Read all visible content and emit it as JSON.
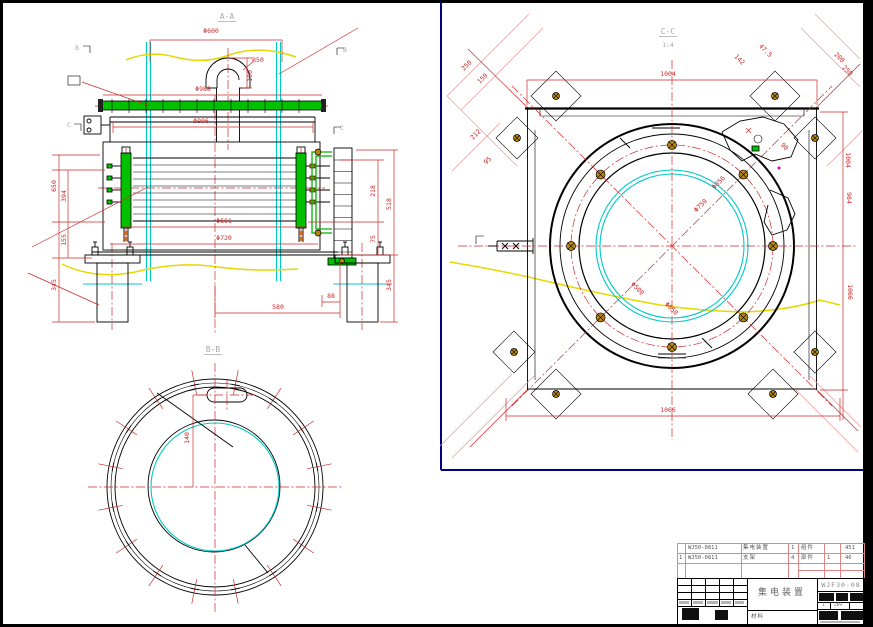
{
  "colors": {
    "dim_red": "#cc2a2a",
    "pink_table": "#e08585",
    "green": "#00c000",
    "cyan": "#00c8c8",
    "yellow": "#e6d800",
    "navy_viewport": "#000080",
    "gray_label": "#a9a9a9",
    "bolt_gold": "#b8860b"
  },
  "view_aa": {
    "label": "A-A",
    "marker_b": "B",
    "marker_c": "C",
    "dims": {
      "d600": "Φ600",
      "r50": "R50",
      "h100": "100",
      "d988": "Φ988",
      "d906": "Φ906",
      "d501": "Φ501",
      "d720": "Φ720",
      "w580": "580",
      "w88": "88",
      "left_650": "650",
      "left_394": "394",
      "left_155": "155",
      "left_345": "345",
      "right_218": "218",
      "right_75": "75",
      "right_518": "518",
      "right_345": "345"
    }
  },
  "view_bb": {
    "label": "B-B",
    "dims": {
      "offset_140": "140"
    }
  },
  "view_cc": {
    "label": "C-C",
    "scale": "1:4",
    "dims": {
      "top_1004": "1004",
      "bottom_1066": "1066",
      "right_984": "984",
      "right_1066": "1066",
      "tr_1004": "1004",
      "d856": "Φ856",
      "d750": "Φ750",
      "d500": "Φ500",
      "d650": "Φ650",
      "tl_250": "250",
      "tl_150": "150",
      "tl_212": "212",
      "tl_95": "95",
      "tr_142": "142",
      "tr_47_5": "47.5",
      "tr_200": "200",
      "tr_250": "250",
      "tr_90": "90"
    }
  },
  "title_block": {
    "parts": [
      {
        "seq": "",
        "code": "WJ50-0811",
        "name": "集电装置",
        "qty": "1",
        "unit": "组件",
        "extra": "",
        "weight": "451"
      },
      {
        "seq": "1",
        "code": "WJ50-0811",
        "name": "支架",
        "qty": "4",
        "unit": "部件",
        "extra": "1",
        "weight": "46"
      }
    ],
    "title": "集电装置",
    "material_label": "材料",
    "drawing_no": "WJF30-08",
    "sheet_no": "1",
    "sheet_code": "209"
  }
}
